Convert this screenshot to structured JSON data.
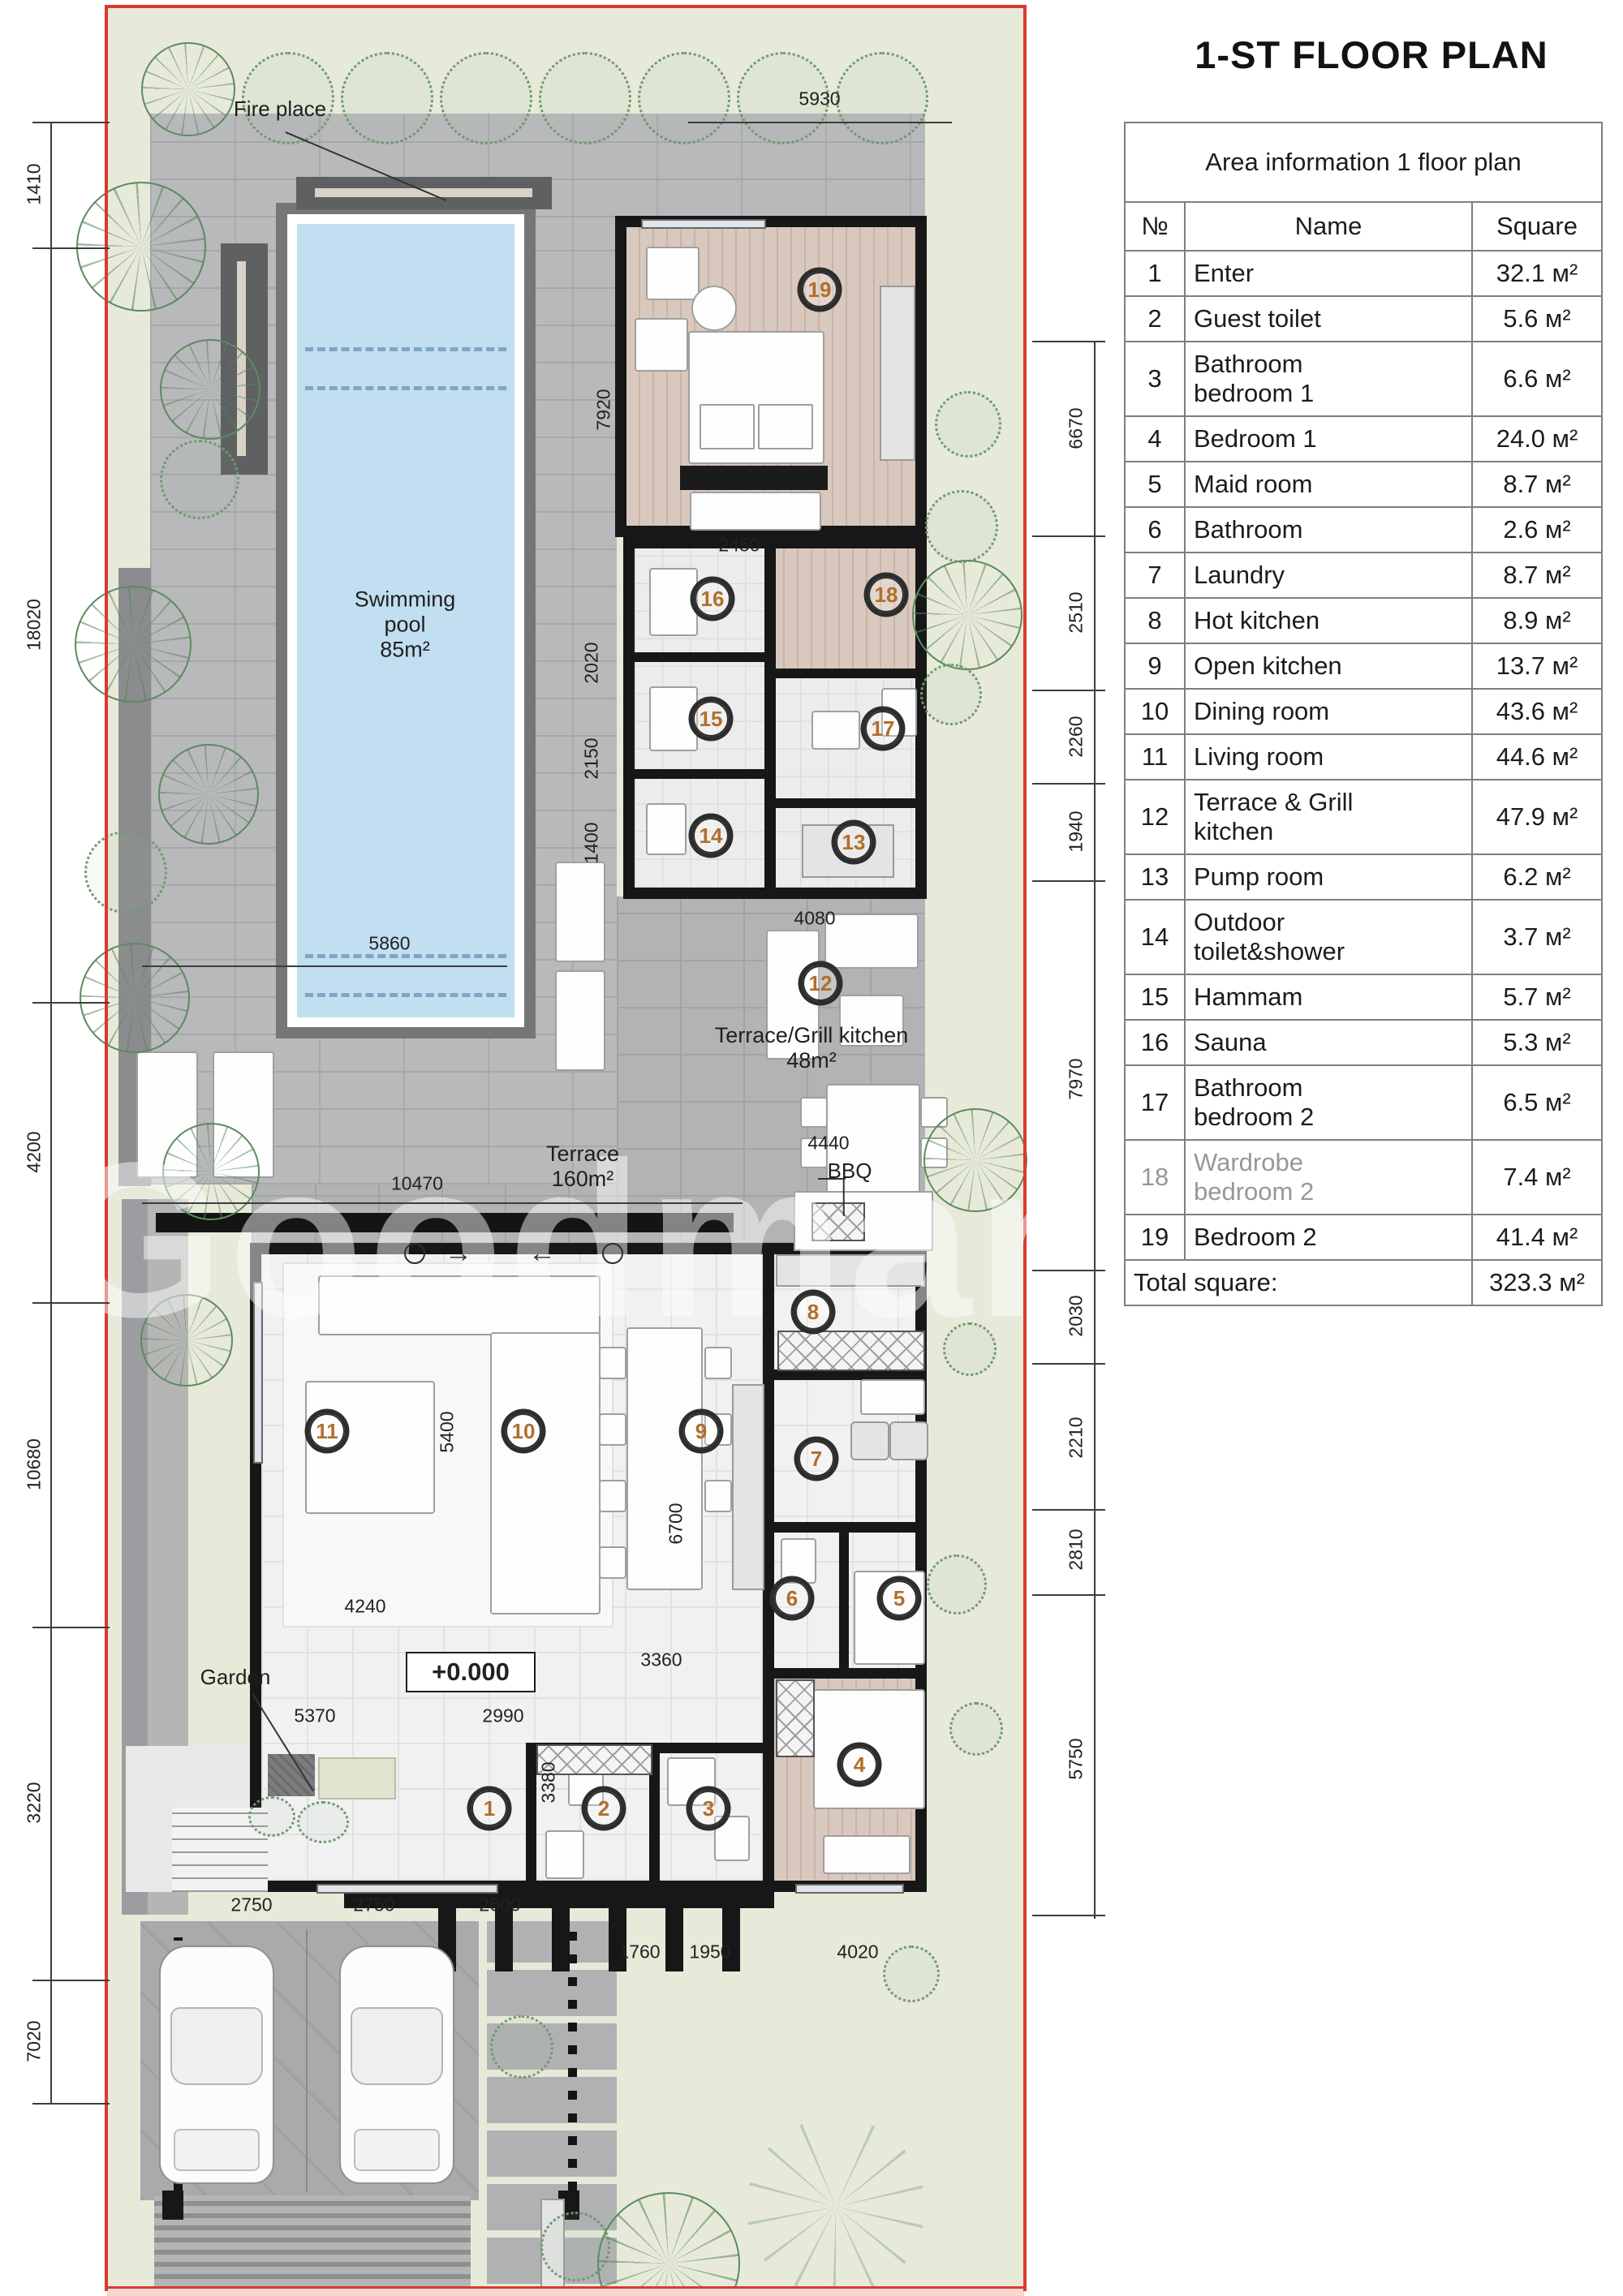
{
  "title": "1-ST FLOOR PLAN",
  "area_table": {
    "caption": "Area information 1 floor plan",
    "col_no": "№",
    "col_name": "Name",
    "col_square": "Square",
    "rows": [
      {
        "no": "1",
        "name": "Enter",
        "square": "32.1 м²"
      },
      {
        "no": "2",
        "name": "Guest toilet",
        "square": "5.6 м²"
      },
      {
        "no": "3",
        "name": "Bathroom\nbedroom 1",
        "square": "6.6 м²"
      },
      {
        "no": "4",
        "name": "Bedroom 1",
        "square": "24.0 м²"
      },
      {
        "no": "5",
        "name": "Maid room",
        "square": "8.7 м²"
      },
      {
        "no": "6",
        "name": "Bathroom",
        "square": "2.6 м²"
      },
      {
        "no": "7",
        "name": "Laundry",
        "square": "8.7 м²"
      },
      {
        "no": "8",
        "name": "Hot kitchen",
        "square": "8.9 м²"
      },
      {
        "no": "9",
        "name": "Open kitchen",
        "square": "13.7 м²"
      },
      {
        "no": "10",
        "name": "Dining room",
        "square": "43.6 м²"
      },
      {
        "no": "11",
        "name": "Living room",
        "square": "44.6 м²"
      },
      {
        "no": "12",
        "name": "Terrace & Grill\nkitchen",
        "square": "47.9 м²"
      },
      {
        "no": "13",
        "name": "Pump room",
        "square": "6.2 м²"
      },
      {
        "no": "14",
        "name": "Outdoor\ntoilet&shower",
        "square": "3.7 м²"
      },
      {
        "no": "15",
        "name": "Hammam",
        "square": "5.7 м²"
      },
      {
        "no": "16",
        "name": "Sauna",
        "square": "5.3 м²"
      },
      {
        "no": "17",
        "name": "Bathroom\nbedroom 2",
        "square": "6.5 м²"
      },
      {
        "no": "18",
        "name": "Wardrobe\nbedroom 2",
        "square": "7.4 м²"
      },
      {
        "no": "19",
        "name": "Bedroom 2",
        "square": "41.4 м²"
      }
    ],
    "total_label": "Total square:",
    "total_value": "323.3 м²"
  },
  "plan": {
    "watermark": "Goodman Bro",
    "labels": {
      "fire_place": "Fire place",
      "pool": "Swimming\npool\n85m²",
      "grill": "Terrace/Grill kitchen\n48m²",
      "terrace": "Terrace\n160m²",
      "bbq": "BBQ",
      "garden": "Garden",
      "elevation": "+0.000",
      "arrow_right": "→",
      "arrow_left": "←"
    },
    "dims": {
      "top": "5930",
      "left": [
        "1410",
        "18020",
        "4200",
        "10680",
        "3220",
        "7020"
      ],
      "right": [
        "6670",
        "2510",
        "2260",
        "1940",
        "7970",
        "2030",
        "2210",
        "2810",
        "5750"
      ],
      "inner": {
        "d7920": "7920",
        "d2450": "2450",
        "d2020": "2020",
        "d2150": "2150",
        "d1400": "1400",
        "d4080": "4080",
        "d5860": "5860",
        "d4440": "4440",
        "d10470": "10470",
        "d5400": "5400",
        "d6700": "6700",
        "d4240": "4240",
        "d3360": "3360",
        "d5370": "5370",
        "d2990": "2990",
        "d3380": "3380",
        "d2750a": "2750",
        "d2750b": "2750",
        "d2600": "2600",
        "d1760": "1760",
        "d1950": "1950",
        "d4020": "4020"
      }
    },
    "room_numbers": {
      "r1": "1",
      "r2": "2",
      "r3": "3",
      "r4": "4",
      "r5": "5",
      "r6": "6",
      "r7": "7",
      "r8": "8",
      "r9": "9",
      "r10": "10",
      "r11": "11",
      "r12": "12",
      "r13": "13",
      "r14": "14",
      "r15": "15",
      "r16": "16",
      "r17": "17",
      "r18": "18",
      "r19": "19"
    }
  }
}
